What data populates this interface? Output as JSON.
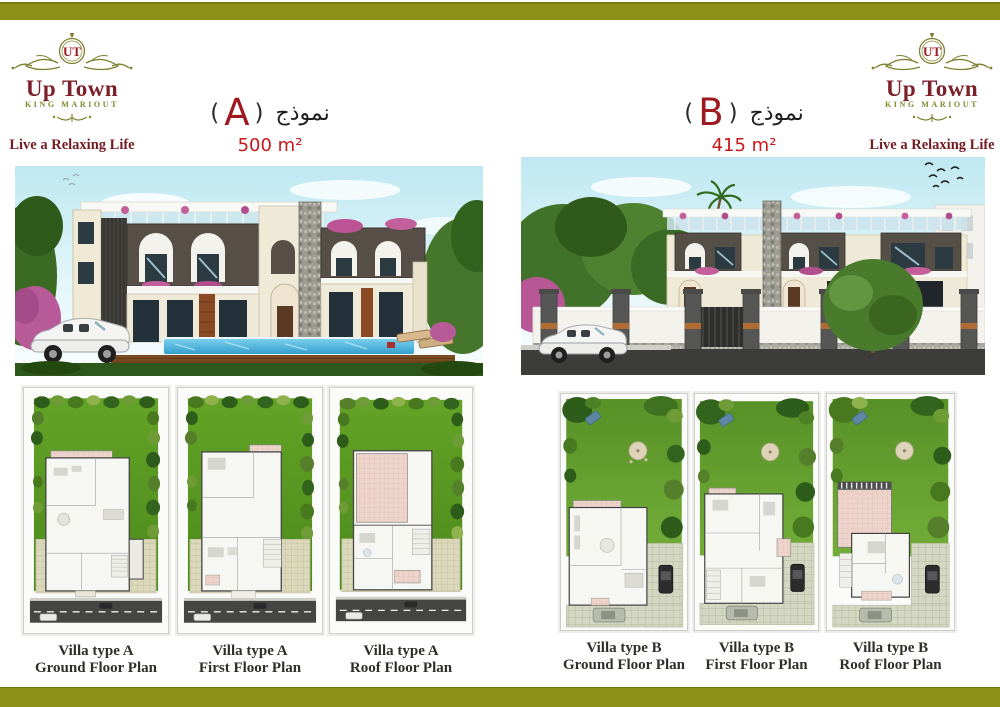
{
  "brand": {
    "title": "Up Town",
    "subtitle": "KING MARIOUT",
    "tagline": "Live a Relaxing Life",
    "monogram": "UT"
  },
  "models": {
    "a": {
      "arabic_word": "نموذج",
      "paren_open": "(",
      "paren_close": ")",
      "letter": "A",
      "area": "500 m²"
    },
    "b": {
      "arabic_word": "نموذج",
      "paren_open": "(",
      "paren_close": ")",
      "letter": "B",
      "area": "415 m²"
    }
  },
  "plans": {
    "a": [
      {
        "line1": "Villa type A",
        "line2": "Ground Floor Plan"
      },
      {
        "line1": "Villa type A",
        "line2": "First Floor Plan"
      },
      {
        "line1": "Villa type A",
        "line2": "Roof Floor Plan"
      }
    ],
    "b": [
      {
        "line1": "Villa type B",
        "line2": "Ground Floor Plan"
      },
      {
        "line1": "Villa type B",
        "line2": "First Floor Plan"
      },
      {
        "line1": "Villa type B",
        "line2": "Roof Floor Plan"
      }
    ]
  },
  "colors": {
    "accent_olive": "#8c9016",
    "brand_maroon": "#7b1f28",
    "area_red": "#c5181c",
    "caption_dark": "#312e29"
  }
}
